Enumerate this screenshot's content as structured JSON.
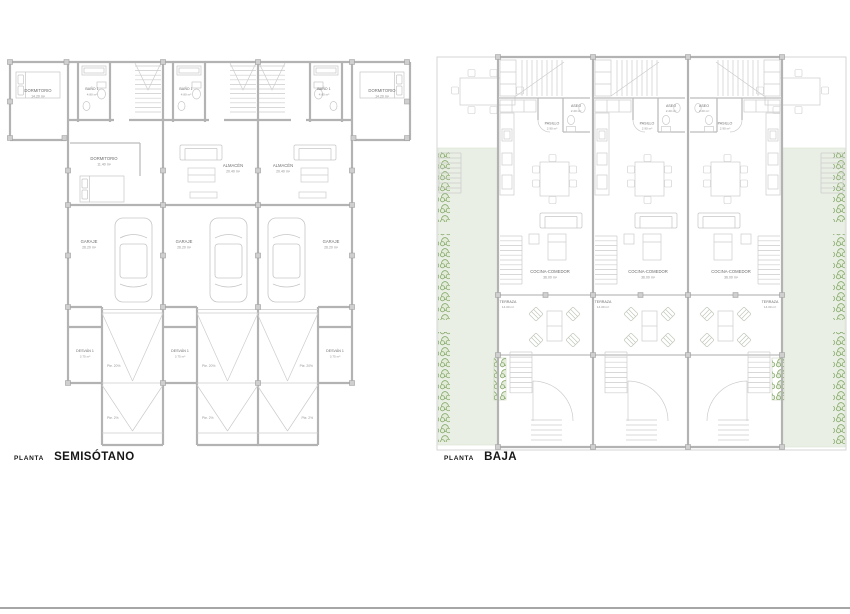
{
  "titles": {
    "semisotano": {
      "prefix": "PLANTA",
      "name": "SEMISÓTANO"
    },
    "baja": {
      "prefix": "PLANTA",
      "name": "BAJA"
    }
  },
  "semisotano_rooms": {
    "dormitorio_wing": {
      "name": "DORMITORIO",
      "area": "14.20 m²"
    },
    "bano1": {
      "name": "BAÑO 1",
      "area": "4.80 m²"
    },
    "dormitorio_interior": {
      "name": "DORMITORIO",
      "area": "11.40 m²"
    },
    "almacen": {
      "name": "ALMACÉN",
      "area": "20.40 m²"
    },
    "garaje": {
      "name": "GARAJE",
      "area": "26.20 m²"
    },
    "desvan": {
      "name": "DESVÁN 1",
      "area": "3.75 m²"
    },
    "pendiente_20": "Pte. 20%",
    "pendiente_2": "Pte. 2%"
  },
  "baja_rooms": {
    "aseo": {
      "name": "ASEO",
      "area": "2.20 m²"
    },
    "pasillo": {
      "name": "PASILLO",
      "area": "2.90 m²"
    },
    "cocina_comedor": {
      "name": "COCINA-COMEDOR",
      "area": "36.00 m²"
    },
    "terraza": {
      "name": "TERRAZA",
      "area": "14.00 m²"
    }
  },
  "colors": {
    "wall_gray": "#b3b3b3",
    "furniture_gray": "#cccccc",
    "garden_green": "#e9efe4",
    "plant_green": "#7aa05e",
    "label_text": "#6d6d6d",
    "title_text": "#161616"
  }
}
